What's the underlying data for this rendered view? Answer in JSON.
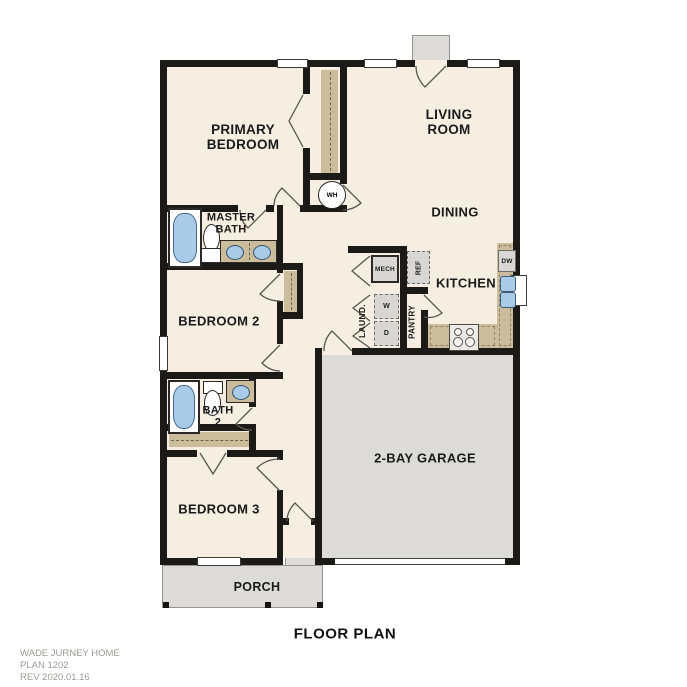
{
  "title": "FLOOR PLAN",
  "footer": {
    "line1": "WADE JURNEY HOME",
    "line2": "PLAN 1202",
    "line3": "REV 2020.01.16"
  },
  "rooms": {
    "primary_bedroom": "PRIMARY BEDROOM",
    "living_room": "LIVING ROOM",
    "dining": "DINING",
    "kitchen": "KITCHEN",
    "master_bath": "MASTER BATH",
    "bedroom_2": "BEDROOM 2",
    "laundry": "LAUND.",
    "pantry": "PANTRY",
    "bath_2": "BATH 2",
    "bedroom_3": "BEDROOM 3",
    "garage": "2-BAY GARAGE",
    "porch": "PORCH"
  },
  "fixtures": {
    "water_heater": "WH",
    "mechanical": "MECH",
    "refrigerator": "REF",
    "dishwasher": "DW",
    "washer": "W",
    "dryer": "D"
  },
  "colors": {
    "floor": "#f5eee1",
    "wall": "#1c1a17",
    "garage_floor": "#dcdbd8",
    "counter": "#cbbc9c",
    "fixture_blue": "#a9cbe8",
    "appliance": "#d8d7d4",
    "footer_text": "#9b9b95",
    "label_text": "#1a1a1a"
  }
}
